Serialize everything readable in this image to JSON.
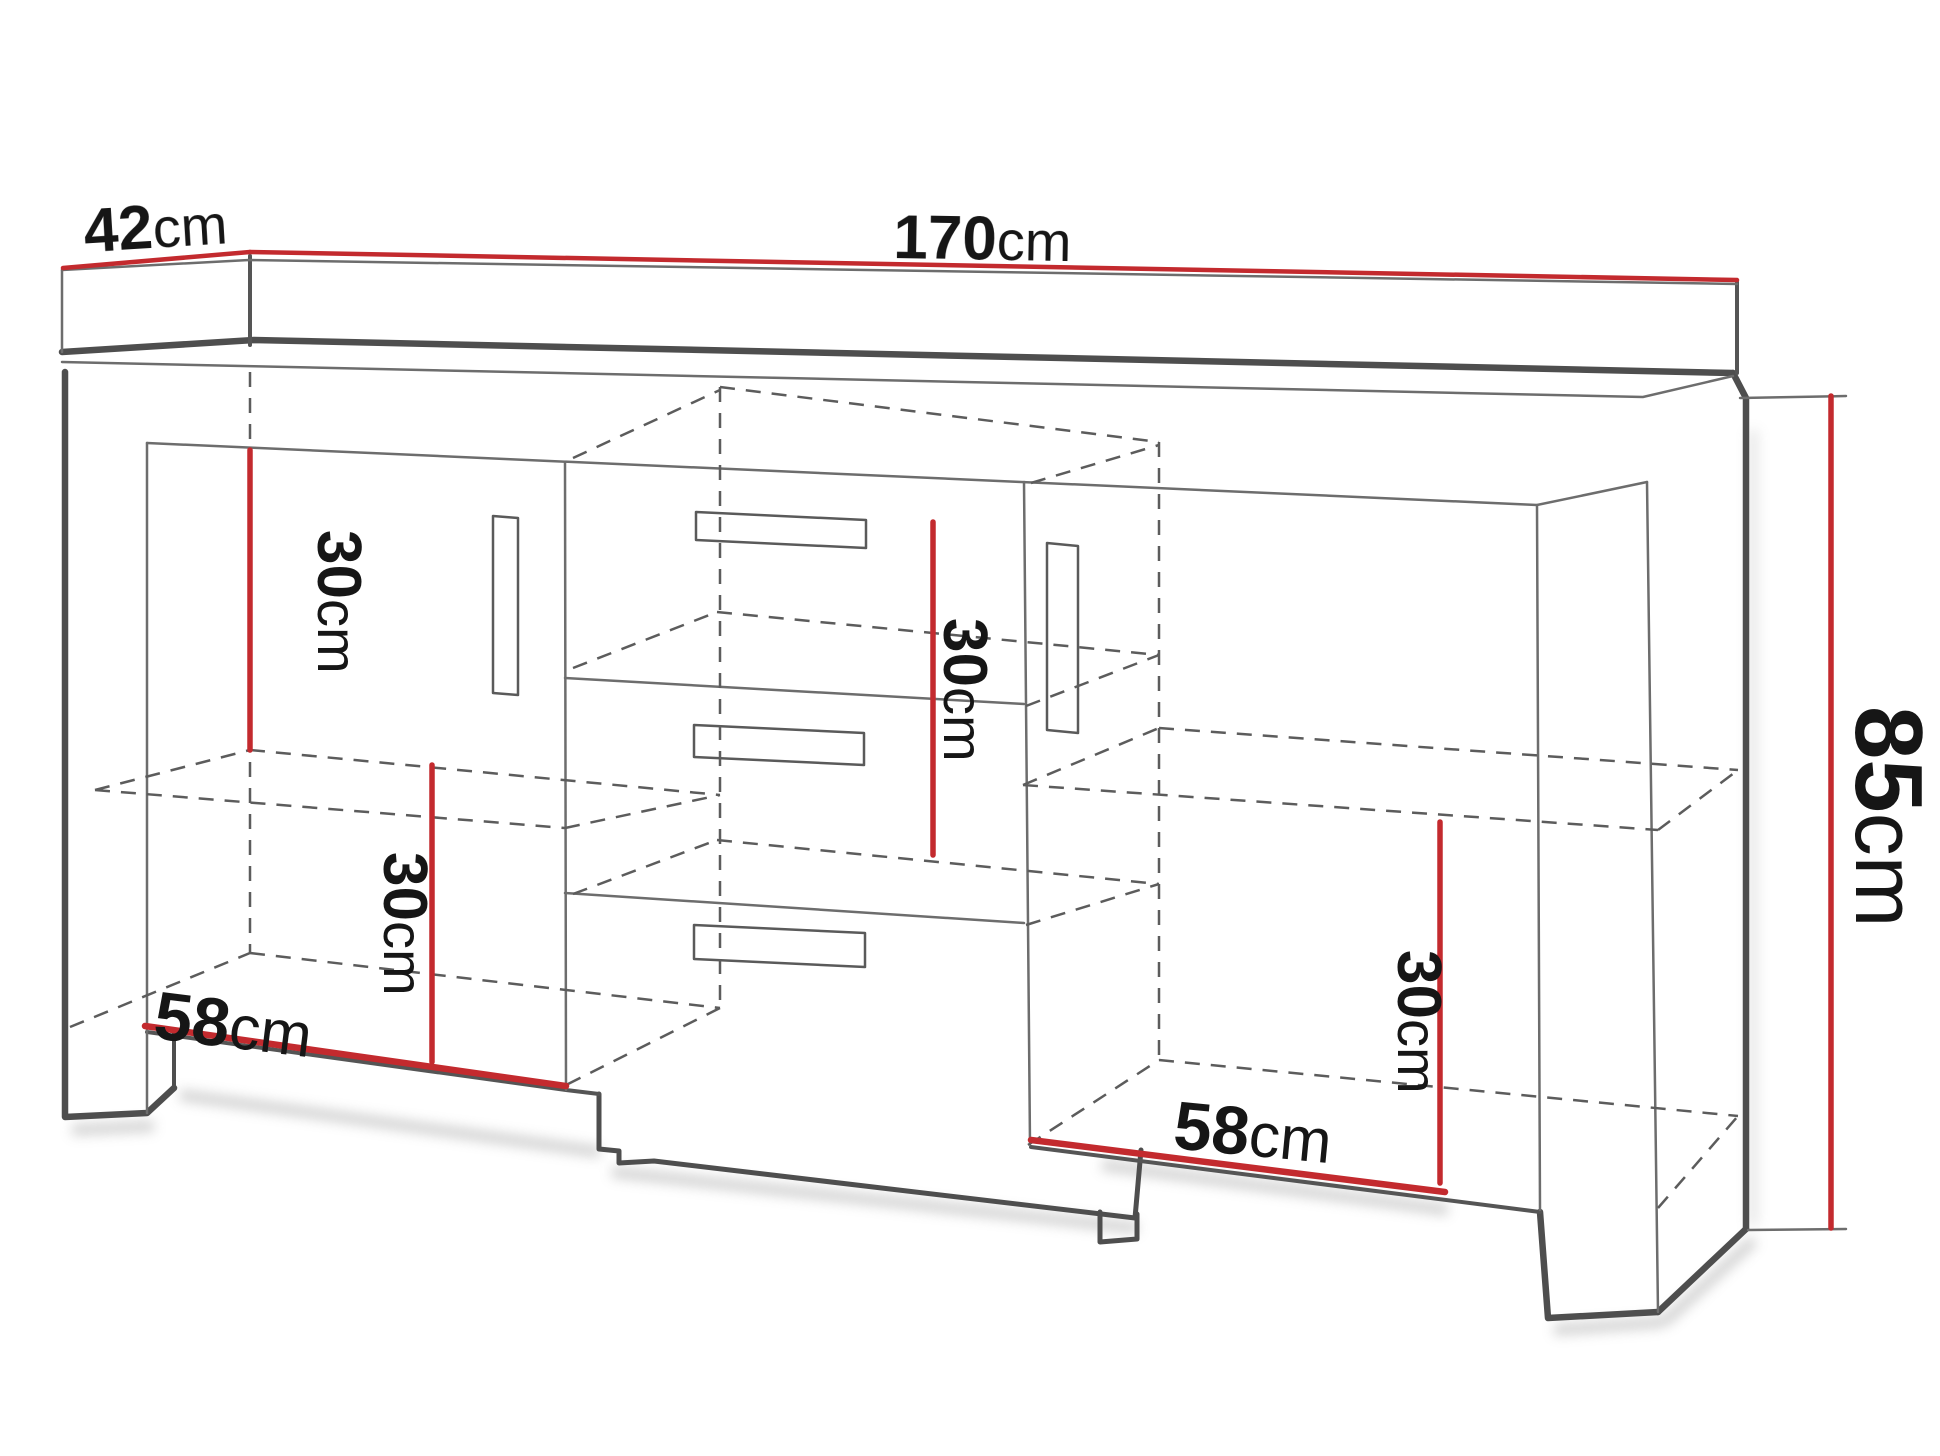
{
  "diagram": {
    "type": "furniture-dimension-drawing",
    "subject": "sideboard with two doors, three center drawers, legs and internal shelves",
    "units": "cm",
    "colors": {
      "background": "#ffffff",
      "dimension_line": "#c32a2e",
      "outline_dark": "#4e4e4e",
      "outline_light": "#6d6d6d",
      "hidden_line": "#5c5c5c",
      "label_text": "#161616"
    },
    "dimensions": {
      "depth": {
        "value": "42",
        "unit": "cm"
      },
      "width": {
        "value": "170",
        "unit": "cm"
      },
      "height": {
        "value": "85",
        "unit": "cm"
      },
      "left_upper_clearance": {
        "value": "30",
        "unit": "cm"
      },
      "left_lower_clearance": {
        "value": "30",
        "unit": "cm"
      },
      "middle_clearance": {
        "value": "30",
        "unit": "cm"
      },
      "right_lower_clearance": {
        "value": "30",
        "unit": "cm"
      },
      "left_compartment_width": {
        "value": "58",
        "unit": "cm"
      },
      "right_compartment_width": {
        "value": "58",
        "unit": "cm"
      }
    }
  }
}
